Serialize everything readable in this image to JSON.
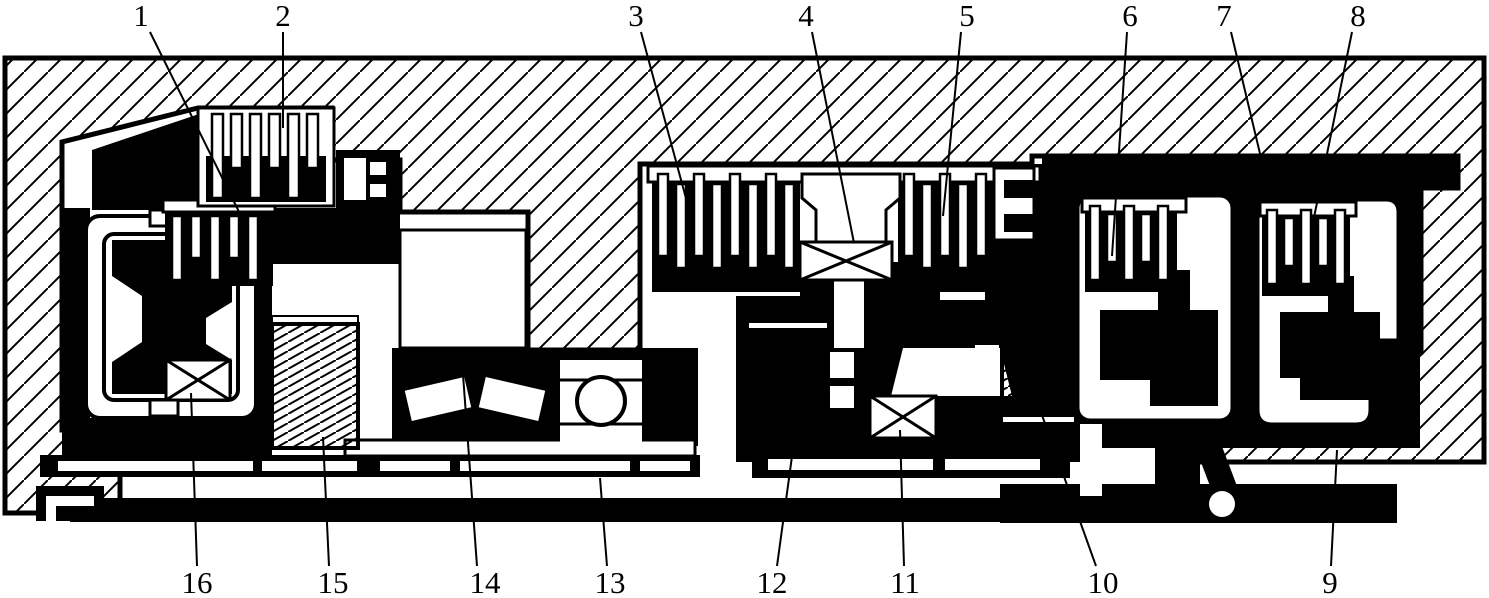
{
  "figure": {
    "type": "mechanical cross-section (patent-style sectional drawing)",
    "ink": "#000000",
    "paper": "#ffffff",
    "width": 1489,
    "height": 598
  },
  "callouts": [
    {
      "label": "1",
      "tx": 141,
      "ty": 26,
      "x1": 150,
      "y1": 32,
      "x2": 248,
      "y2": 230
    },
    {
      "label": "2",
      "tx": 283,
      "ty": 26,
      "x1": 283,
      "y1": 32,
      "x2": 283,
      "y2": 128
    },
    {
      "label": "3",
      "tx": 636,
      "ty": 26,
      "x1": 641,
      "y1": 32,
      "x2": 687,
      "y2": 202
    },
    {
      "label": "4",
      "tx": 806,
      "ty": 26,
      "x1": 812,
      "y1": 32,
      "x2": 854,
      "y2": 243
    },
    {
      "label": "5",
      "tx": 967,
      "ty": 26,
      "x1": 961,
      "y1": 32,
      "x2": 943,
      "y2": 216
    },
    {
      "label": "6",
      "tx": 1130,
      "ty": 26,
      "x1": 1127,
      "y1": 32,
      "x2": 1112,
      "y2": 256
    },
    {
      "label": "7",
      "tx": 1224,
      "ty": 26,
      "x1": 1231,
      "y1": 32,
      "x2": 1262,
      "y2": 162
    },
    {
      "label": "8",
      "tx": 1358,
      "ty": 26,
      "x1": 1352,
      "y1": 32,
      "x2": 1311,
      "y2": 232
    },
    {
      "label": "9",
      "tx": 1330,
      "ty": 593,
      "x1": 1331,
      "y1": 566,
      "x2": 1337,
      "y2": 450
    },
    {
      "label": "10",
      "tx": 1103,
      "ty": 593,
      "x1": 1096,
      "y1": 566,
      "x2": 1038,
      "y2": 404
    },
    {
      "label": "11",
      "tx": 905,
      "ty": 593,
      "x1": 904,
      "y1": 566,
      "x2": 900,
      "y2": 430
    },
    {
      "label": "12",
      "tx": 772,
      "ty": 593,
      "x1": 777,
      "y1": 566,
      "x2": 793,
      "y2": 449
    },
    {
      "label": "13",
      "tx": 610,
      "ty": 593,
      "x1": 607,
      "y1": 566,
      "x2": 600,
      "y2": 478
    },
    {
      "label": "14",
      "tx": 485,
      "ty": 593,
      "x1": 477,
      "y1": 566,
      "x2": 461,
      "y2": 347
    },
    {
      "label": "15",
      "tx": 333,
      "ty": 593,
      "x1": 329,
      "y1": 566,
      "x2": 323,
      "y2": 437
    },
    {
      "label": "16",
      "tx": 197,
      "ty": 593,
      "x1": 197,
      "y1": 566,
      "x2": 191,
      "y2": 393
    }
  ]
}
